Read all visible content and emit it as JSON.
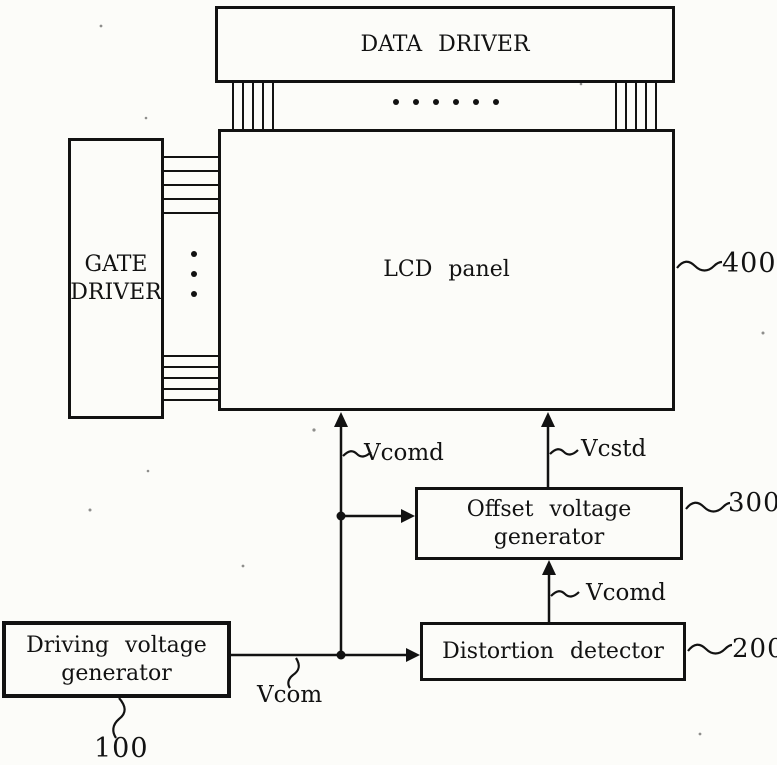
{
  "figure": {
    "type": "block-diagram",
    "ink_color": "#121212",
    "paper_color": "#fcfcf9",
    "boxes": {
      "data_driver": {
        "label": "DATA DRIVER"
      },
      "gate_driver": {
        "line1": "GATE",
        "line2": "DRIVER"
      },
      "lcd_panel": {
        "label": "LCD panel",
        "ref": "400"
      },
      "offset_voltage_generator": {
        "line1": "Offset voltage",
        "line2": "generator",
        "ref": "300"
      },
      "distortion_detector": {
        "label": "Distortion detector",
        "ref": "200"
      },
      "driving_voltage_generator": {
        "line1": "Driving voltage",
        "line2": "generator",
        "ref": "100"
      }
    },
    "signals": {
      "vcomd_upper": "Vcomd",
      "vcstd": "Vcstd",
      "vcomd_lower": "Vcomd",
      "vcom": "Vcom"
    }
  }
}
